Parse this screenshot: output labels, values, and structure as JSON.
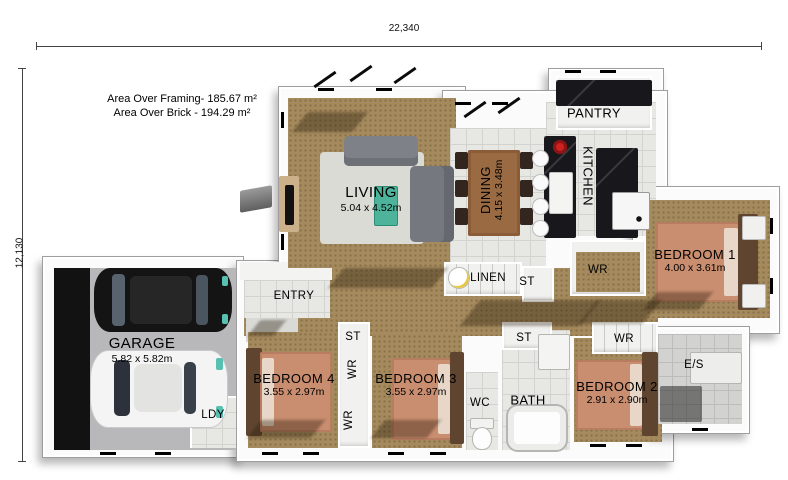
{
  "dimensions": {
    "width_label": "22,340",
    "height_label": "12,130"
  },
  "notes": {
    "framing": "Area Over Framing- 185.67 m²",
    "brick": "Area Over Brick - 194.29 m²"
  },
  "rooms": {
    "living": {
      "label": "LIVING",
      "size": "5.04 x 4.52m"
    },
    "dining": {
      "label": "DINING",
      "size": "4.15 x 3.48m"
    },
    "kitchen": {
      "label": "KITCHEN"
    },
    "pantry": {
      "label": "PANTRY"
    },
    "entry": {
      "label": "ENTRY"
    },
    "garage": {
      "label": "GARAGE",
      "size": "5.82 x 5.82m"
    },
    "laundry": {
      "label": "LDY"
    },
    "linen": {
      "label": "LINEN"
    },
    "store_hall": {
      "label": "ST"
    },
    "wr_master": {
      "label": "WR"
    },
    "bedroom1": {
      "label": "BEDROOM 1",
      "size": "4.00 x 3.61m"
    },
    "bedroom2": {
      "label": "BEDROOM 2",
      "size": "2.91 x 2.90m"
    },
    "bedroom3": {
      "label": "BEDROOM 3",
      "size": "3.55 x 2.97m"
    },
    "bedroom4": {
      "label": "BEDROOM 4",
      "size": "3.55 x 2.97m"
    },
    "store_bed43": {
      "label": "ST"
    },
    "wr_bed4": {
      "label": "WR"
    },
    "wr_bed3": {
      "label": "WR"
    },
    "store_bath": {
      "label": "ST"
    },
    "bath": {
      "label": "BATH"
    },
    "wc": {
      "label": "WC"
    },
    "wr_bed2": {
      "label": "WR"
    },
    "ensuite": {
      "label": "E/S"
    }
  },
  "colors": {
    "carpet": "#a58a5e",
    "tile": "#e7e7e4",
    "wall": "#ffffff",
    "bench_marble": "#17171c",
    "bed": "#c98d70",
    "headboard": "#5f4430",
    "coffee_table": "#4db39b",
    "car_black": "#141414",
    "car_white": "#f4f4f4",
    "cooktop_red": "#cc2222"
  }
}
